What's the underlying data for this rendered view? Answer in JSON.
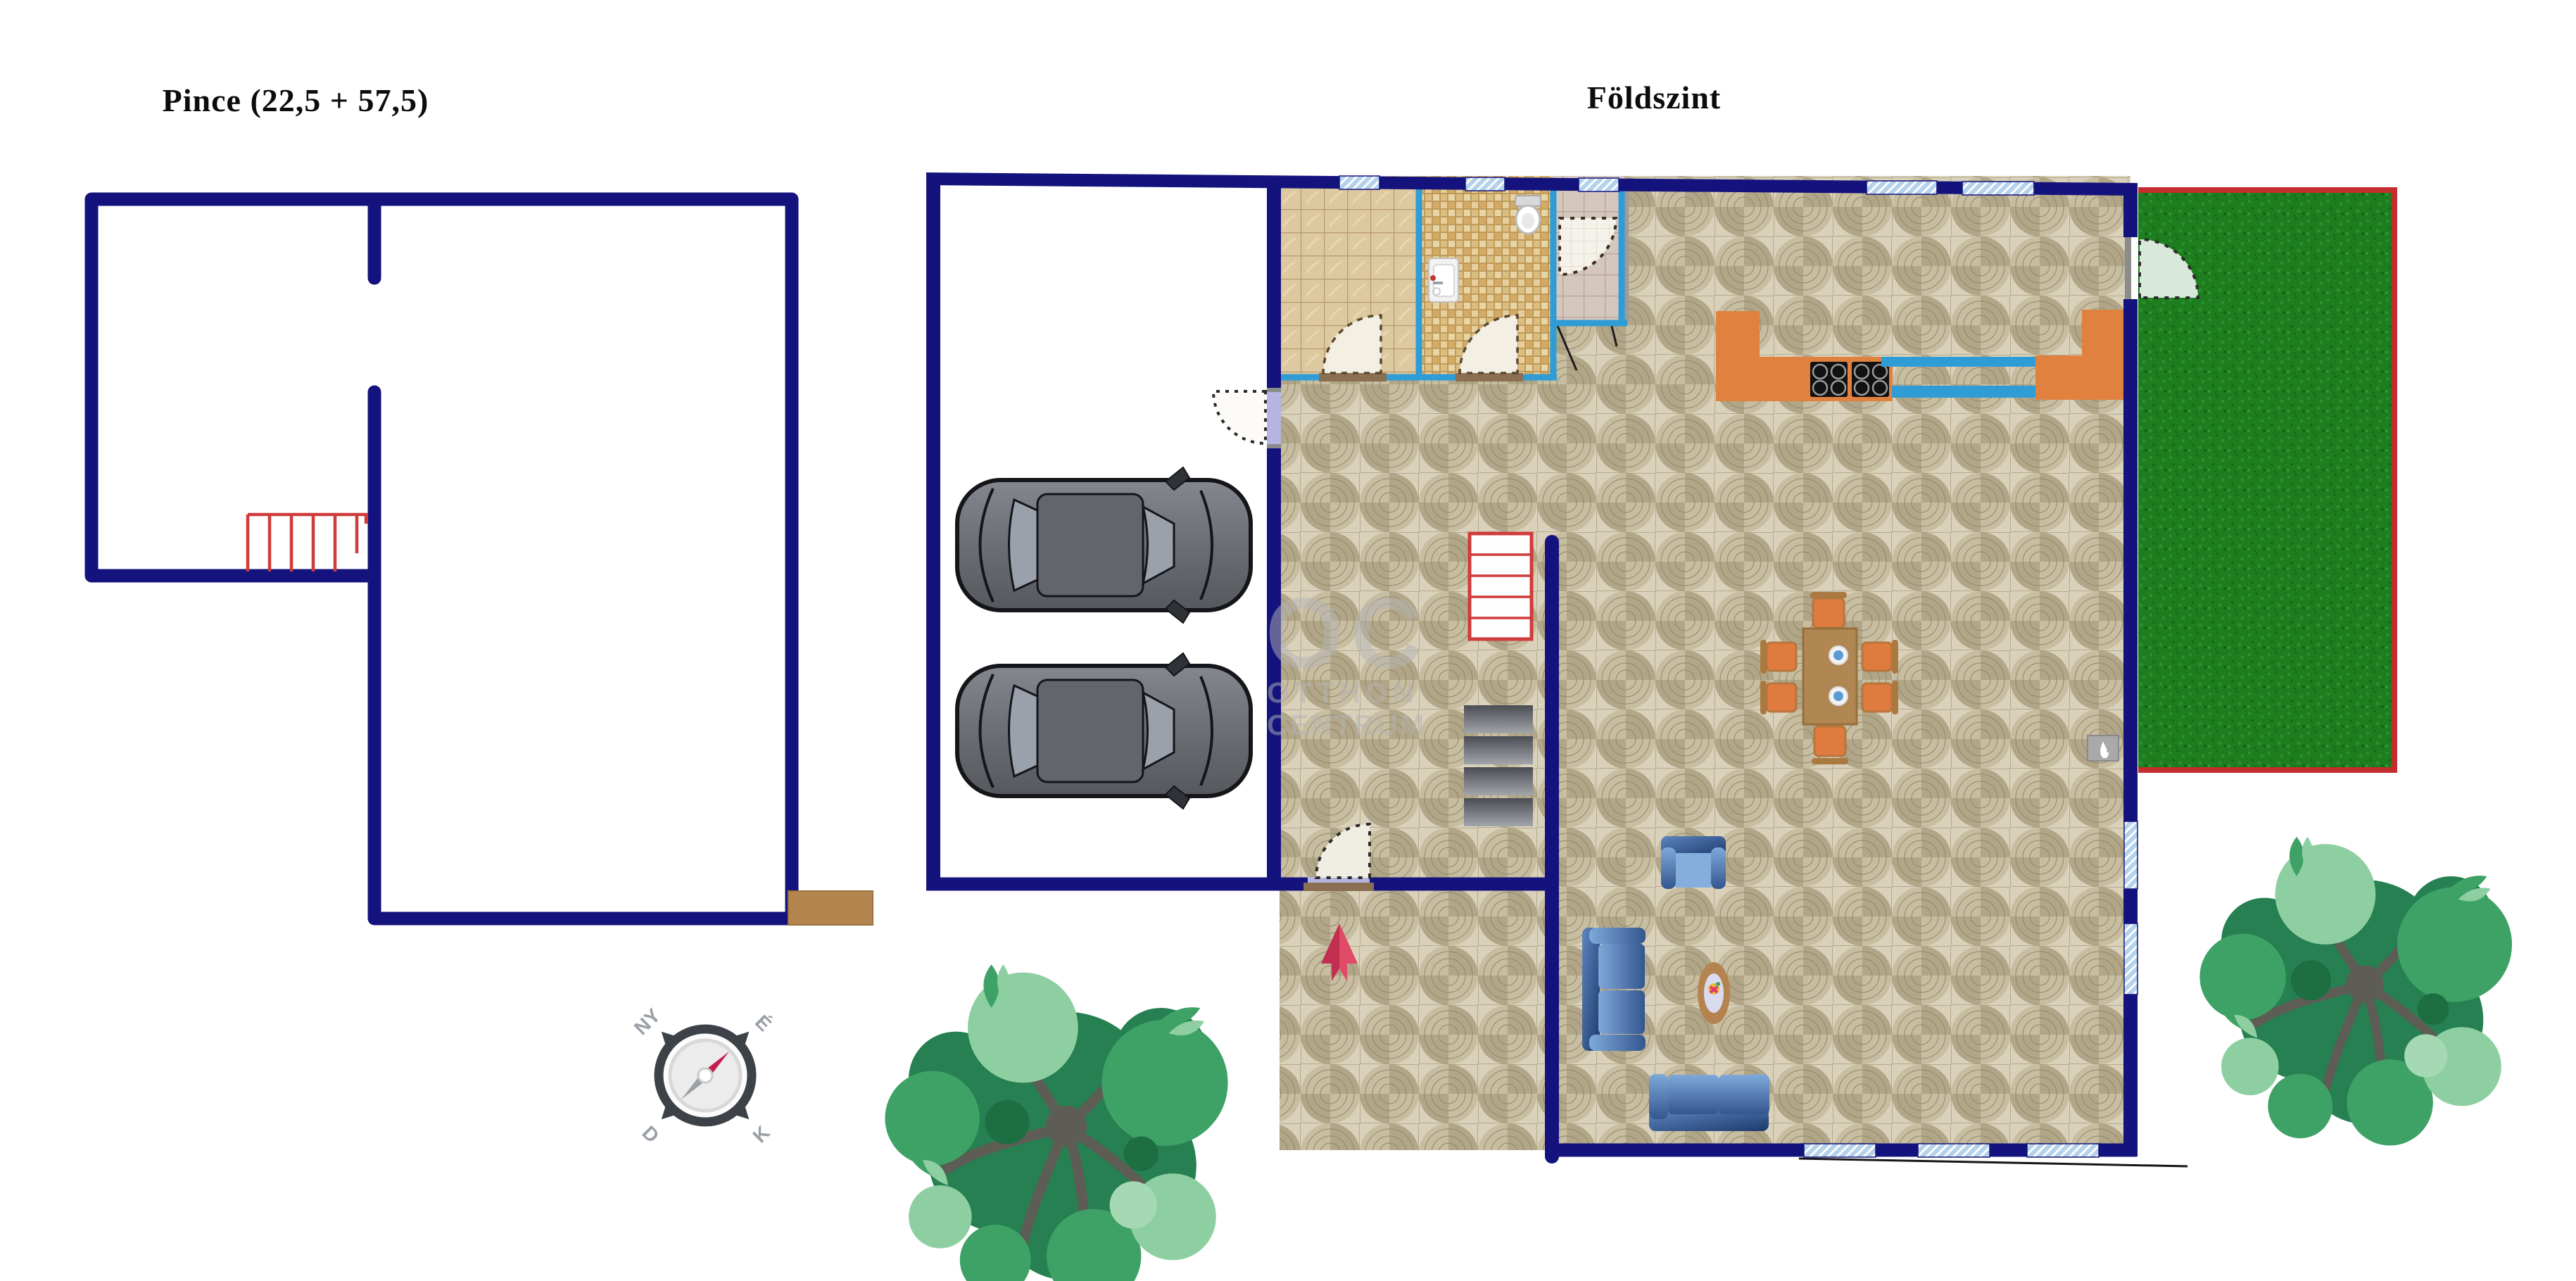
{
  "titles": {
    "basement": "Pince (22,5 + 57,5)",
    "ground": "Földszint"
  },
  "watermark": {
    "initials": "OC",
    "line1": "OTTHON",
    "line2": "CENTRUM"
  },
  "compass": {
    "nw": "NY",
    "ne": "É",
    "sw": "D",
    "se": "K"
  },
  "colors": {
    "outer_wall_navy": "#14137d",
    "interior_wall_blue": "#2f9cd6",
    "window_fill": "#b3d2ec",
    "stairs_red": "#cf3a3a",
    "kitchen_counter_orange": "#e0813f",
    "grass_green": "#1e7d1e",
    "grass_border_red": "#c32d2d",
    "cellar_exit_brown": "#b5854f",
    "entrance_arrow_red": "#e04a67",
    "sofa_blue": "#7fa9da",
    "dining_table_brown": "#b08653",
    "floor_tile_beige": "#d9d1ba",
    "door_leaf_cream": "#f3efe3"
  }
}
